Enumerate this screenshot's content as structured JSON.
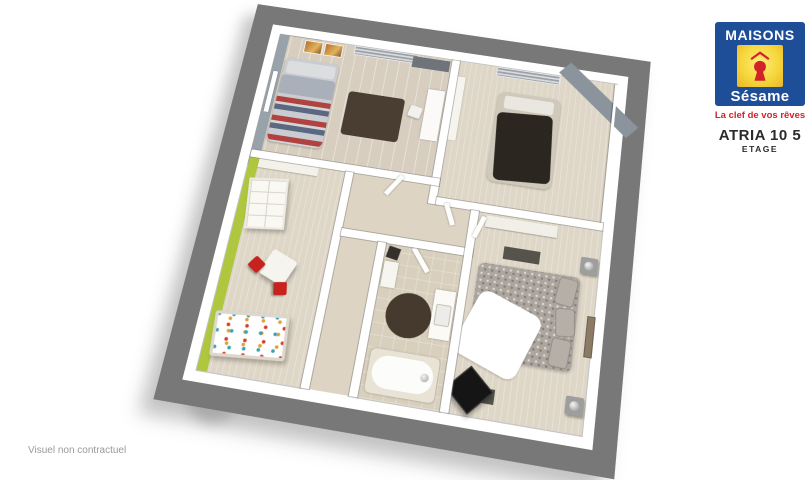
{
  "brand": {
    "logo_top": "MAISONS",
    "logo_bottom": "Sésame",
    "tagline": "La clef de vos rêves",
    "colors": {
      "blue": "#1e4e97",
      "yellow": "#f6d73c",
      "red": "#d3222a"
    }
  },
  "plan_label": {
    "title": "ATRIA 10 5",
    "subtitle": "ETAGE"
  },
  "disclaimer": "Visuel non contractuel",
  "floor_plan": {
    "type": "3d-rendered-floor-plan",
    "colors": {
      "outer_wall": "#787878",
      "inner_wall": "#ffffff",
      "floor_beige": "#ddd4c3",
      "accent_green": "#aec73f",
      "accent_blue_gray": "#97a2aa",
      "rug_brown": "#4a3e33",
      "red_chair": "#c6231f"
    },
    "rooms": [
      "bedroom-1-striped-bed",
      "bedroom-2-dark-bed",
      "kids-bedroom",
      "landing-hallway",
      "staircase",
      "bathroom",
      "master-bedroom"
    ]
  }
}
